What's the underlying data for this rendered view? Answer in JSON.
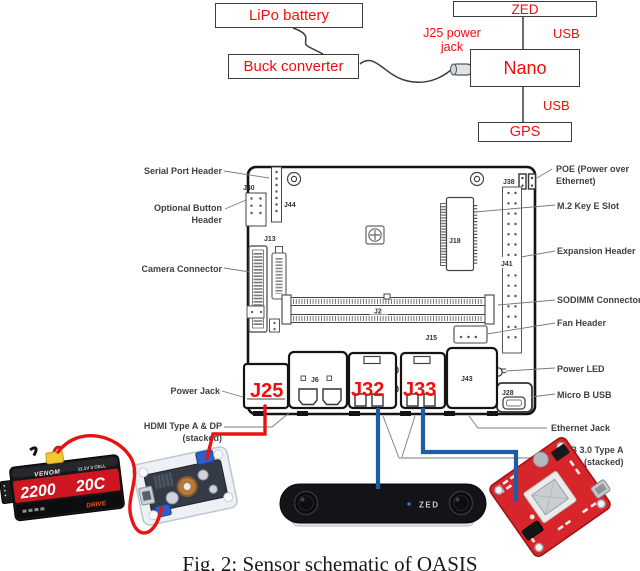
{
  "caption": "Fig. 2: Sensor schematic of OASIS",
  "colors": {
    "red": "#f20d0d",
    "blue": "#1d5ca6"
  },
  "top_diagram": {
    "lipo_battery": "LiPo battery",
    "buck_converter": "Buck converter",
    "zed": "ZED",
    "nano": "Nano",
    "gps": "GPS",
    "jack_label_line1": "J25 power",
    "jack_label_line2": "jack",
    "usb_top": "USB",
    "usb_bottom": "USB"
  },
  "board": {
    "left_labels": {
      "serial": "Serial Port Header",
      "optional1": "Optional Button",
      "optional2": "Header",
      "camera": "Camera Connector",
      "power_jack": "Power Jack",
      "hdmi1": "HDMI Type A & DP",
      "hdmi2": "(stacked)"
    },
    "right_labels": {
      "poe1": "POE (Power over",
      "poe2": "Ethernet)",
      "m2": "M.2 Key E Slot",
      "expansion": "Expansion Header",
      "sodimm": "SODIMM Connector",
      "fan": "Fan Header",
      "power_led": "Power LED",
      "micro_b": "Micro B USB",
      "ethernet": "Ethernet Jack",
      "usb3_1": "USB 3.0 Type A",
      "usb3_2": "(stacked)"
    },
    "refs": {
      "j40": "J40",
      "j44": "J44",
      "j13": "J13",
      "j18": "J18",
      "j41": "J41",
      "j38": "J38",
      "j2": "J2",
      "j15": "J15",
      "j43": "J43",
      "j6": "J6",
      "j28": "J28"
    },
    "ports": {
      "j25": "J25",
      "j32": "J32",
      "j33": "J33"
    }
  },
  "photos": {
    "battery": {
      "brand": "VENOM",
      "spec": "11.1V 3 CELL",
      "capacity": "2200",
      "rating": "20C",
      "series": "DRIVE"
    },
    "zed_camera": {
      "label": "ZED"
    }
  }
}
